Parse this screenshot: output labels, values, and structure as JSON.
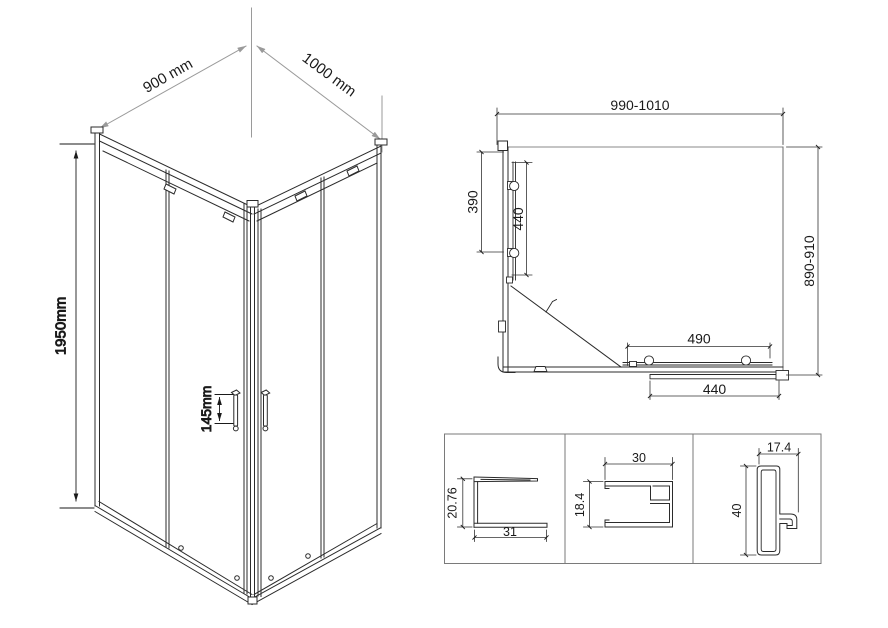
{
  "iso": {
    "width": "900 mm",
    "depth": "1000 mm",
    "height": "1950mm",
    "handle_spacing": "145mm"
  },
  "plan": {
    "width_range": "990-1010",
    "depth_range": "890-910",
    "side_fixed_panel": "390",
    "side_door_panel": "440",
    "front_door_travel": "490",
    "front_door_panel": "440"
  },
  "profiles": [
    {
      "height": "20.76",
      "width": "31"
    },
    {
      "width": "30",
      "height": "18.4"
    },
    {
      "width": "17.4",
      "height": "40"
    }
  ],
  "colors": {
    "line": "#2b2b2b",
    "construction": "#9a9a9a",
    "dimension": "#1a1a1a",
    "background": "#ffffff"
  }
}
